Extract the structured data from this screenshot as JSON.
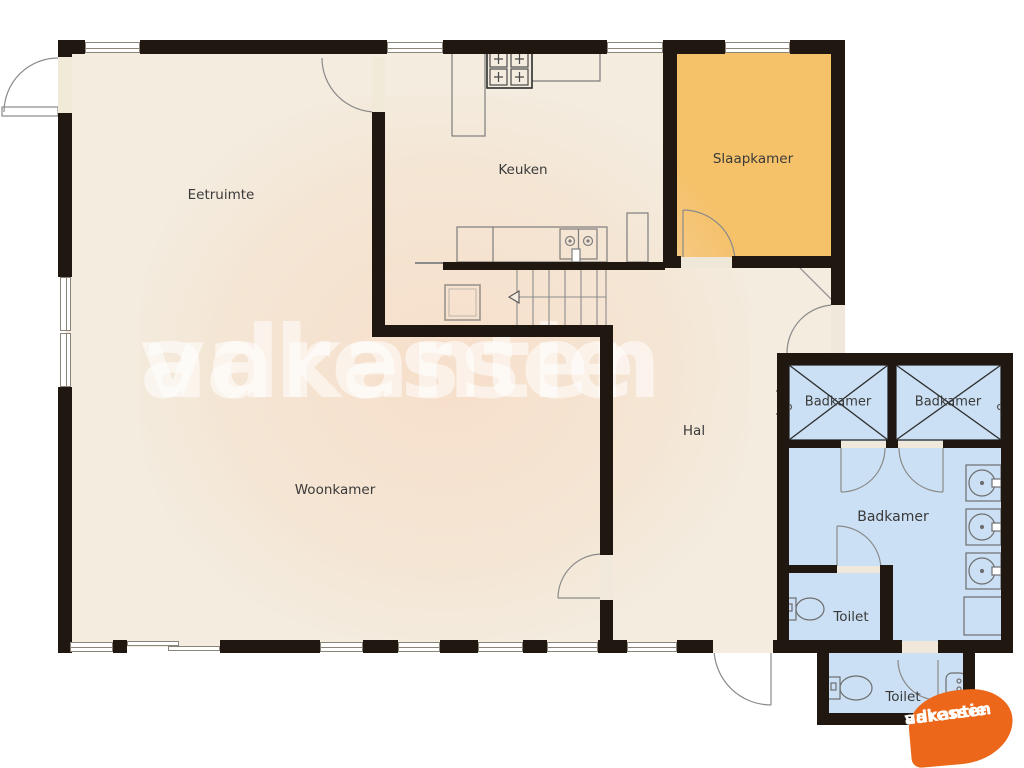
{
  "rooms": {
    "eetruimte": "Eetruimte",
    "keuken": "Keuken",
    "slaapkamer": "Slaapkamer",
    "hal": "Hal",
    "woonkamer": "Woonkamer",
    "badkamer_left": "Badkamer",
    "badkamer_right": "Badkamer",
    "badkamer_main": "Badkamer",
    "toilet_upper": "Toilet",
    "toilet_lower": "Toilet"
  },
  "watermark": {
    "line1": "vakantie",
    "line2": "adressen"
  },
  "logo": {
    "line1": "vakantie",
    "line2": "adressen"
  },
  "colors": {
    "wall": "#201710",
    "floor": "#f3ecdf",
    "bedroom": "#f5c169",
    "bath": "#cbe0f4",
    "logo": "#ec6719"
  }
}
